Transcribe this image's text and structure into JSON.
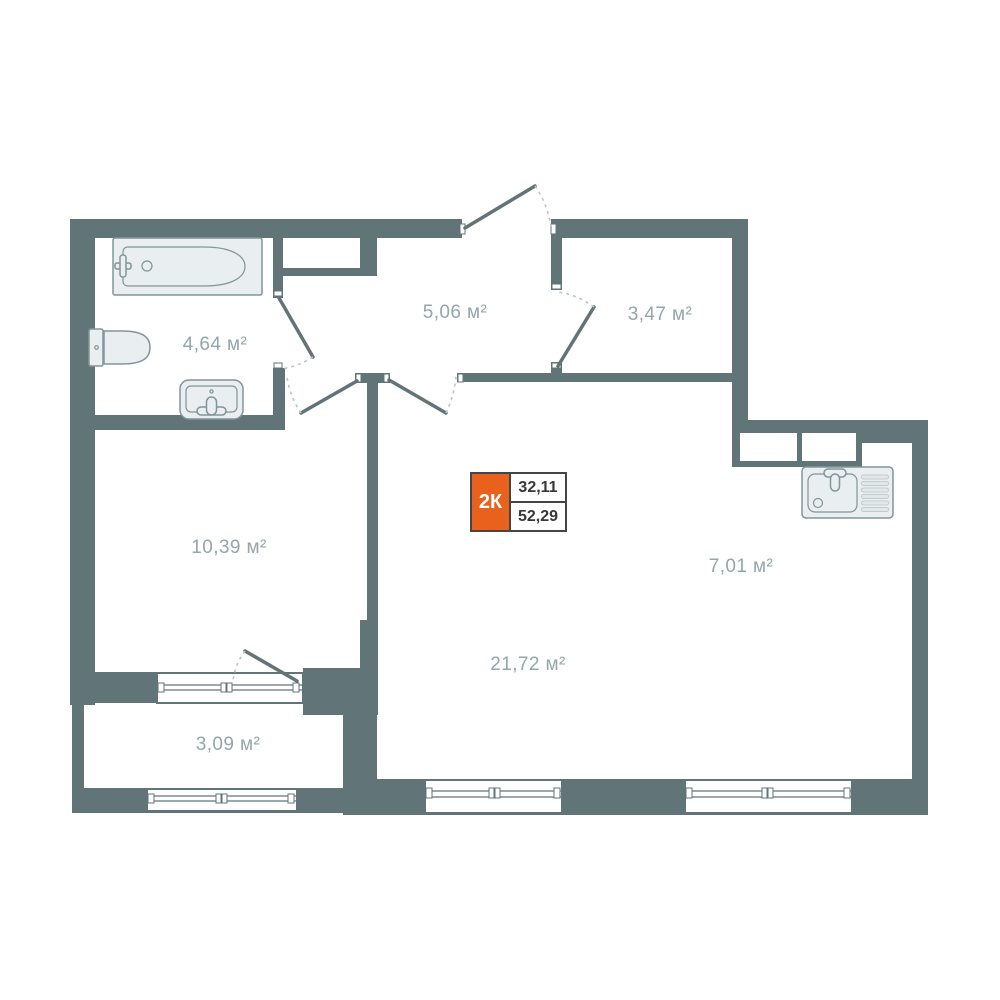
{
  "plan": {
    "badge": {
      "label": "2К",
      "area_living": "32,11",
      "area_total": "52,29"
    },
    "rooms": [
      {
        "id": "bathroom",
        "area_label": "4,64 м²"
      },
      {
        "id": "hallway",
        "area_label": "5,06 м²"
      },
      {
        "id": "storage",
        "area_label": "3,47 м²"
      },
      {
        "id": "bedroom",
        "area_label": "10,39 м²"
      },
      {
        "id": "living",
        "area_label": "21,72 м²"
      },
      {
        "id": "kitchen",
        "area_label": "7,01 м²"
      },
      {
        "id": "balcony",
        "area_label": "3,09 м²"
      }
    ],
    "fixtures": [
      "bathtub",
      "toilet",
      "washbasin",
      "kitchen-sink"
    ],
    "colors": {
      "wall": "#617579",
      "accent": "#e8611d",
      "label": "#95a6a9",
      "arc": "#b9c5c7",
      "fixture_fill": "#e9eef0",
      "fixture_stroke": "#81959a",
      "badge_border": "#454545",
      "badge_text": "#383838"
    }
  }
}
